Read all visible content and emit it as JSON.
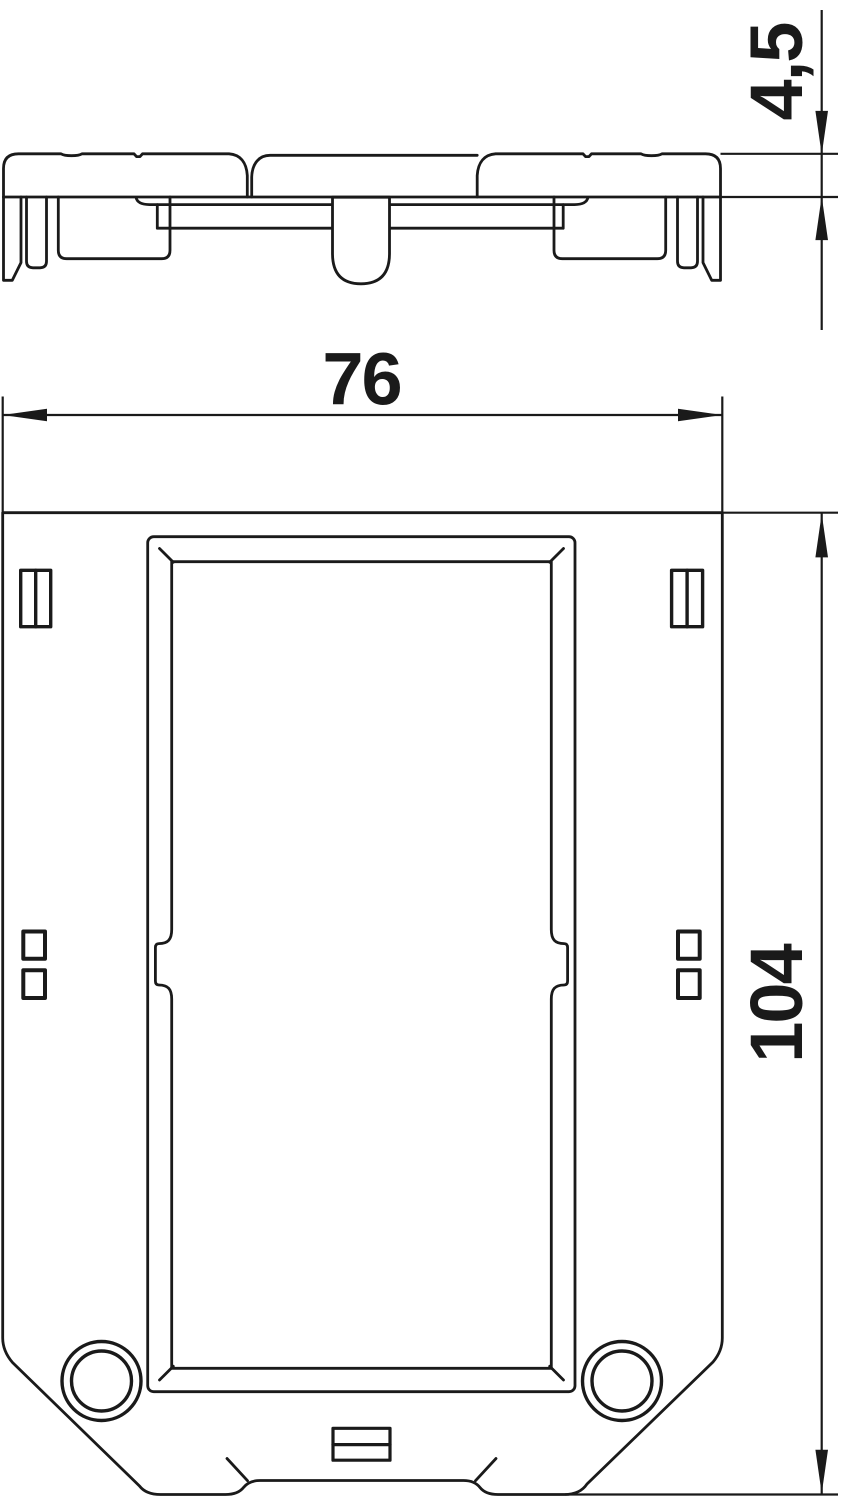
{
  "drawing": {
    "description": "technical drawing, two views of a mounting frame",
    "dim_width": {
      "value": "76"
    },
    "dim_height": {
      "value": "104"
    },
    "dim_thickness": {
      "value": "4,5"
    },
    "colors": {
      "line": "#1a1a1a",
      "background": "#ffffff"
    }
  }
}
